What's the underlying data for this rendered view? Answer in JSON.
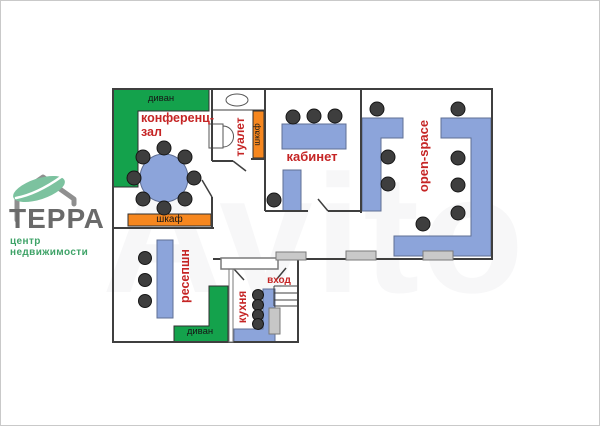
{
  "logo": {
    "title": "ТЕРРА",
    "subtitle": "центр недвижимости"
  },
  "watermark": "Avito",
  "plan": {
    "rooms": {
      "conference": {
        "label": "конференц-зал"
      },
      "toilet": {
        "label": "туалет"
      },
      "cabinet": {
        "label": "кабинет"
      },
      "open_space": {
        "label": "open-space"
      },
      "reception": {
        "label": "ресепшн"
      },
      "kitchen": {
        "label": "кухня"
      },
      "entrance": {
        "label": "вход"
      }
    },
    "furniture": {
      "sofa_top": {
        "label": "диван"
      },
      "sofa_bottom": {
        "label": "диван"
      },
      "closet_conference": {
        "label": "шкаф"
      },
      "closet_toilet": {
        "label": "шкаф"
      }
    },
    "colors": {
      "sofa_green": "#14a24c",
      "closet_orange": "#f6871f",
      "furniture_blue": "#8ca4da",
      "label_red": "#c52525",
      "wall_gray": "#3f3f3f",
      "window_gray": "#c9c9c9",
      "logo_leaf_green": "#7cc29f",
      "logo_text_gray": "#6a6a6a",
      "logo_subtitle_green": "#3fa368"
    }
  }
}
